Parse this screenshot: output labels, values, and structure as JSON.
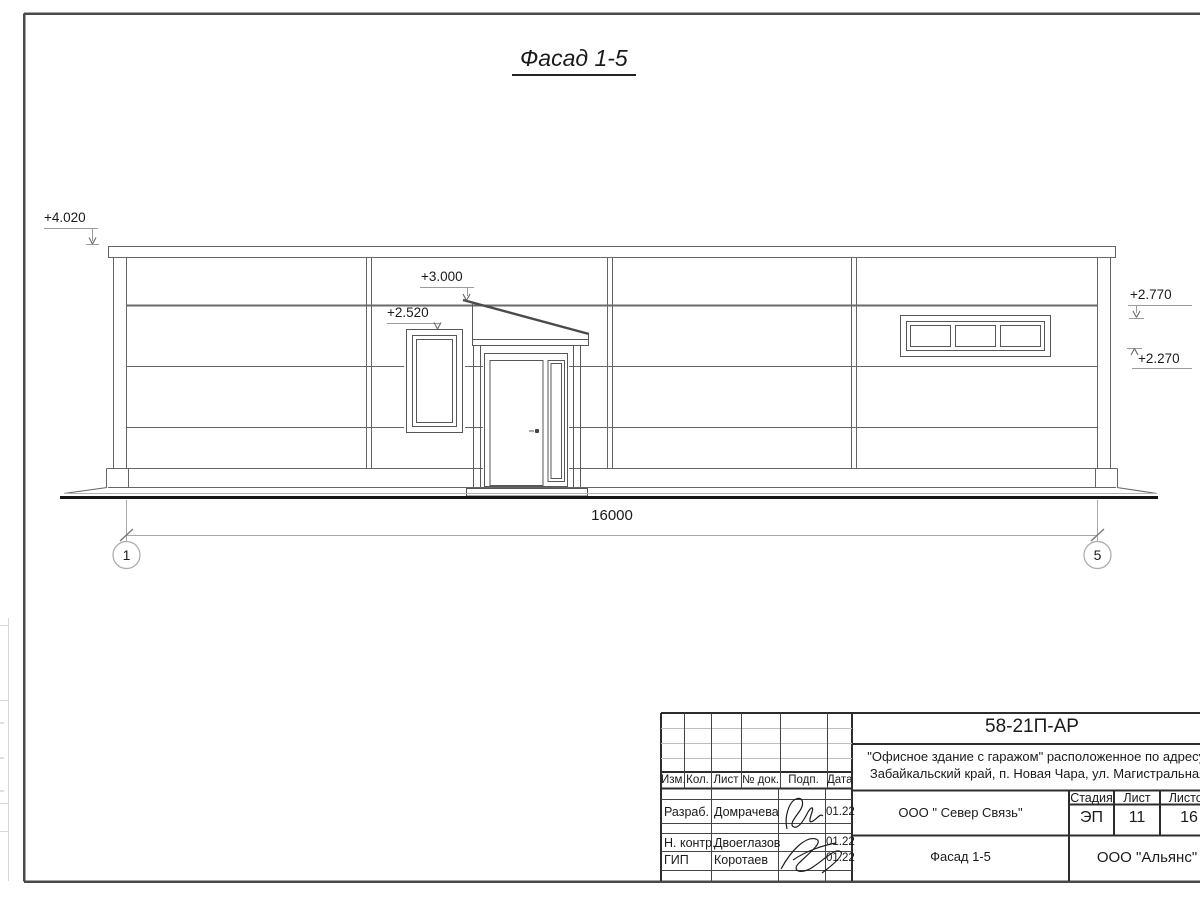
{
  "drawing": {
    "title": "Фасад 1-5",
    "levels": {
      "l4020": "+4.020",
      "l3000": "+3.000",
      "l2520": "+2.520",
      "l2770": "+2.770",
      "l2270": "+2.270"
    },
    "dimension_total": "16000",
    "axis_left": "1",
    "axis_right": "5"
  },
  "title_block": {
    "doc_number": "58-21П-АР",
    "address_line1": "\"Офисное здание с гаражом\" расположенное по адресу:",
    "address_line2": "Забайкальский край, п. Новая Чара, ул. Магистральная",
    "headers": {
      "izm": "Изм.",
      "kol": "Кол.",
      "list": "Лист",
      "dok": "№ док.",
      "podp": "Подп.",
      "data": "Дата"
    },
    "rows": [
      {
        "role": "Разраб.",
        "name": "Домрачева",
        "date": "01.22"
      },
      {
        "role": "Н. контр.",
        "name": "Двоеглазов",
        "date": "01.22"
      },
      {
        "role": "ГИП",
        "name": "Коротаев",
        "date": "01.22"
      }
    ],
    "company": "ООО \" Север Связь\"",
    "sheet_title": "Фасад 1-5",
    "stage_label": "Стадия",
    "stage": "ЭП",
    "sheet_label": "Лист",
    "sheet": "11",
    "sheets_label": "Листов",
    "sheets": "16",
    "firm": "ООО \"Альянс\""
  },
  "colors": {
    "frame": "#4a4a4a",
    "building_line": "#666666",
    "ground_line": "#161616",
    "dim_line": "#a9a9a9",
    "text": "#1a1a1a"
  }
}
